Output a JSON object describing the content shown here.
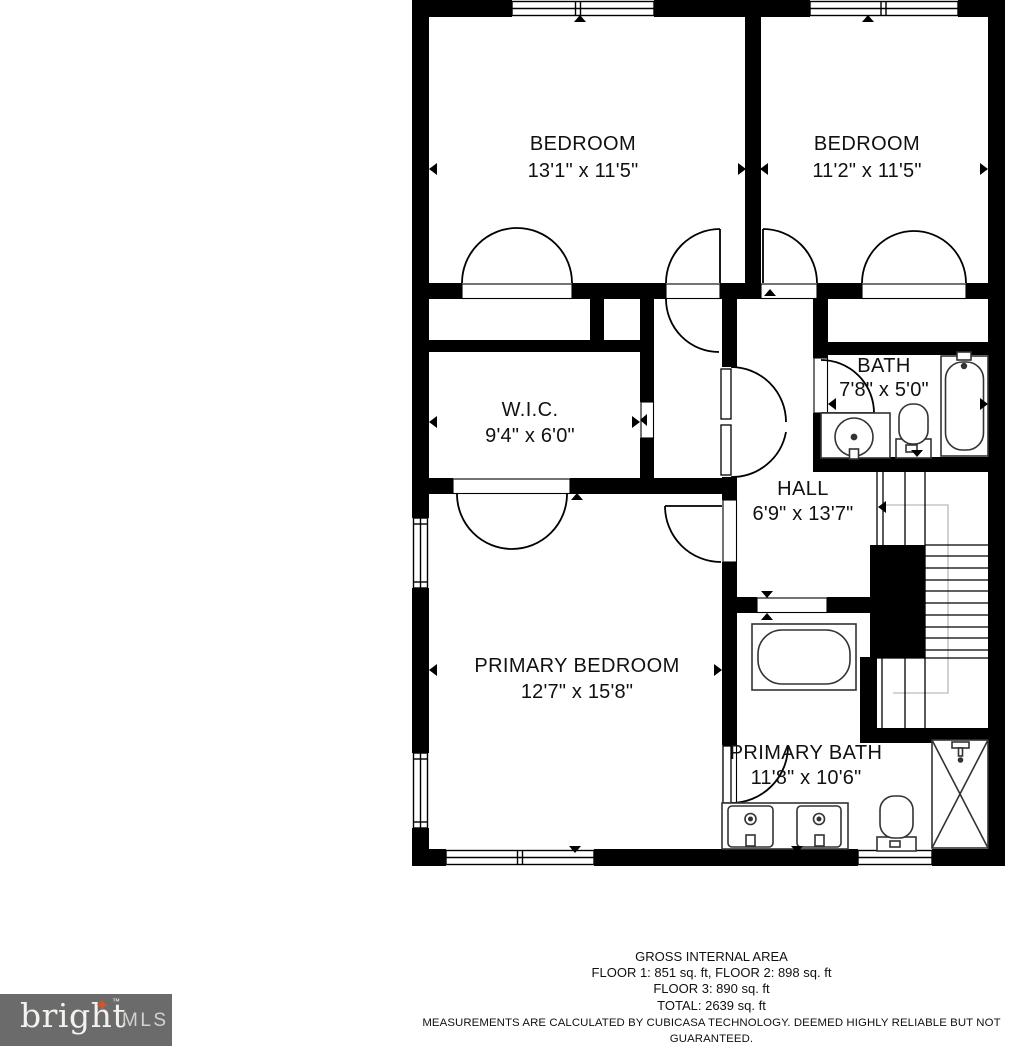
{
  "plan": {
    "rooms": [
      {
        "id": "bedroom-1",
        "name": "BEDROOM",
        "dims": "13'1\" x 11'5\""
      },
      {
        "id": "bedroom-2",
        "name": "BEDROOM",
        "dims": "11'2\" x 11'5\""
      },
      {
        "id": "bath",
        "name": "BATH",
        "dims": "7'8\" x 5'0\""
      },
      {
        "id": "wic",
        "name": "W.I.C.",
        "dims": "9'4\" x 6'0\""
      },
      {
        "id": "hall",
        "name": "HALL",
        "dims": "6'9\" x 13'7\""
      },
      {
        "id": "primary-bedroom",
        "name": "PRIMARY BEDROOM",
        "dims": "12'7\" x 15'8\""
      },
      {
        "id": "primary-bath",
        "name": "PRIMARY BATH",
        "dims": "11'8\" x 10'6\""
      }
    ],
    "wall_color": "#000000",
    "walkline_color": "#c6c6c6",
    "fixtures": [
      "bathtub-icon",
      "toilet-icon",
      "round-sink-icon",
      "double-vanity-icon",
      "freestanding-tub-icon",
      "shower-icon",
      "staircase"
    ]
  },
  "footer": {
    "title": "GROSS INTERNAL AREA",
    "line1": "FLOOR 1: 851 sq. ft, FLOOR 2: 898 sq. ft",
    "line2": "FLOOR 3: 890 sq. ft",
    "line3": "TOTAL: 2639 sq. ft",
    "disclaimer": "MEASUREMENTS ARE CALCULATED BY CUBICASA TECHNOLOGY. DEEMED HIGHLY RELIABLE BUT NOT GUARANTEED."
  },
  "logo": {
    "brand": "bright",
    "suffix": "MLS",
    "trademark": "™",
    "star": "✦",
    "bg_color": "#6b6b6b",
    "star_color": "#dd5227"
  }
}
